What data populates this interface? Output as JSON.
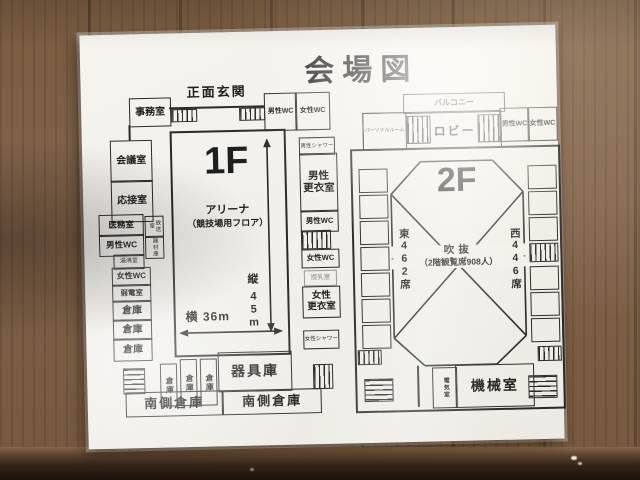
{
  "title": "会場図",
  "f1": {
    "big_label": "1F",
    "arena_name": "アリーナ",
    "arena_note": "（競技場用フロア）",
    "entrance_label": "正面玄関",
    "office": "事務室",
    "mens_wc": "男性WC",
    "womens_wc": "女性WC",
    "meeting_room": "会議室",
    "reception_room": "応接室",
    "medical_room": "医務室",
    "kettle_room": "湯沸室",
    "low_voltage_room": "弱電室",
    "storage": "倉庫",
    "broadcast_room": "放送室",
    "equipment_room_small": "器材庫",
    "mens_shower": "男性シャワー",
    "mens_locker": "男性\n更衣室",
    "womens_locker": "女性\n更衣室",
    "womens_shower": "女性シャワー",
    "nursing_room": "授乳室",
    "width_label": "横 36m",
    "depth_label": "縦",
    "depth_value": "45m",
    "equipment_store": "器具庫",
    "south_storage": "南側倉庫"
  },
  "f2": {
    "big_label": "2F",
    "balcony": "バルコニー",
    "personal_room": "パーソナルルーム",
    "lobby": "ロビー",
    "mens_wc": "男性WC",
    "womens_wc": "女性WC",
    "atrium": "吹抜",
    "atrium_note": "（2階観覧席908人）",
    "east_seats": "東462席",
    "west_seats": "西446席",
    "electrical_room": "電気室",
    "machine_room": "機械室"
  }
}
